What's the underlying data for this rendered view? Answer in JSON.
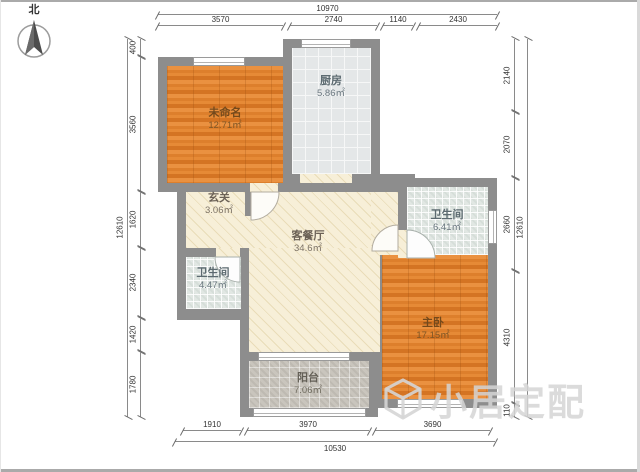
{
  "compass": {
    "label": "北"
  },
  "watermark": {
    "text": "小居定配"
  },
  "rooms": [
    {
      "id": "unnamed",
      "name": "未命名",
      "area": "12.71㎡"
    },
    {
      "id": "kitchen",
      "name": "厨房",
      "area": "5.86㎡"
    },
    {
      "id": "foyer",
      "name": "玄关",
      "area": "3.06㎡"
    },
    {
      "id": "living-dining",
      "name": "客餐厅",
      "area": "34.6㎡"
    },
    {
      "id": "bathroom-right",
      "name": "卫生间",
      "area": "6.41㎡"
    },
    {
      "id": "bathroom-left",
      "name": "卫生间",
      "area": "4.47㎡"
    },
    {
      "id": "master-bedroom",
      "name": "主卧",
      "area": "17.15㎡"
    },
    {
      "id": "balcony",
      "name": "阳台",
      "area": "7.06㎡"
    }
  ],
  "dimensions": {
    "top_total": "10970",
    "top_segments": [
      "3570",
      "2740",
      "1140",
      "2430"
    ],
    "left_total": "12610",
    "left_segments": [
      "400",
      "3560",
      "1620",
      "2340",
      "1420",
      "1780"
    ],
    "right_total": "12610",
    "right_segments": [
      "2140",
      "2070",
      "2660",
      "4310",
      "110"
    ],
    "bottom_total": "10530",
    "bottom_segments": [
      "1910",
      "3970",
      "3690"
    ]
  },
  "colors": {
    "wall": "#8d8d8d",
    "wood_floor": "#e0802e",
    "living_floor": "#f7efd8",
    "kitchen_tile": "#e4e7e8",
    "bath_tile": "#e1e7e3",
    "balcony_tile": "#c9c5bd",
    "dimension_text": "#333333",
    "watermark_gray": "#d5d5d5"
  }
}
